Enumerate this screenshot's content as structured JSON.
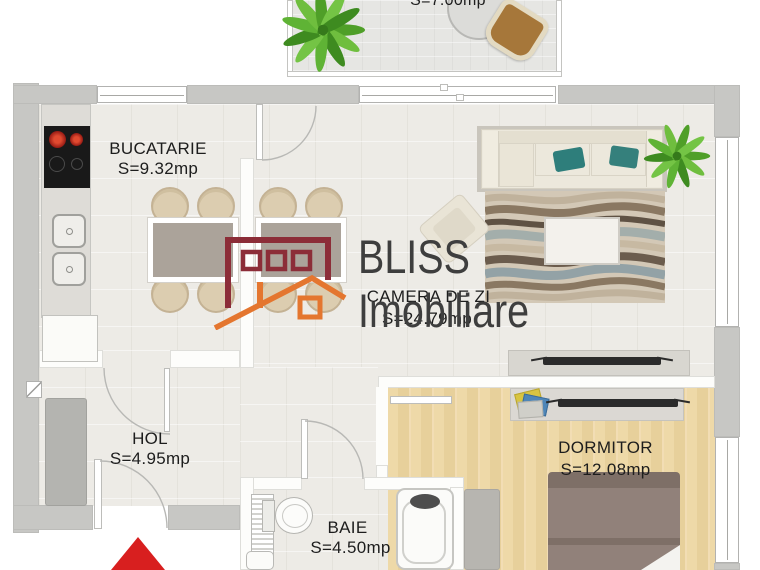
{
  "brand": {
    "name": "BLISS",
    "suffix": "Imobiliare"
  },
  "rooms": {
    "balcon": {
      "area": "S=7.00mp"
    },
    "bucatarie": {
      "name": "BUCATARIE",
      "area": "S=9.32mp"
    },
    "camera_de_zi": {
      "name": "CAMERA DE ZI",
      "area": "S=24.79mp"
    },
    "hol": {
      "name": "HOL",
      "area": "S=4.95mp"
    },
    "baie": {
      "name": "BAIE",
      "area": "S=4.50mp"
    },
    "dormitor": {
      "name": "DORMITOR",
      "area": "S=12.08mp"
    }
  },
  "colors": {
    "wall_gray": "#c7c7c4",
    "wood_floor": "#ecd7a6",
    "logo_red": "#8c2d38",
    "logo_orange": "#e4762f",
    "logo_text": "#3e3e3e",
    "teal_pillow": "#2e7e7b",
    "entrance_red": "#d81f1f"
  }
}
